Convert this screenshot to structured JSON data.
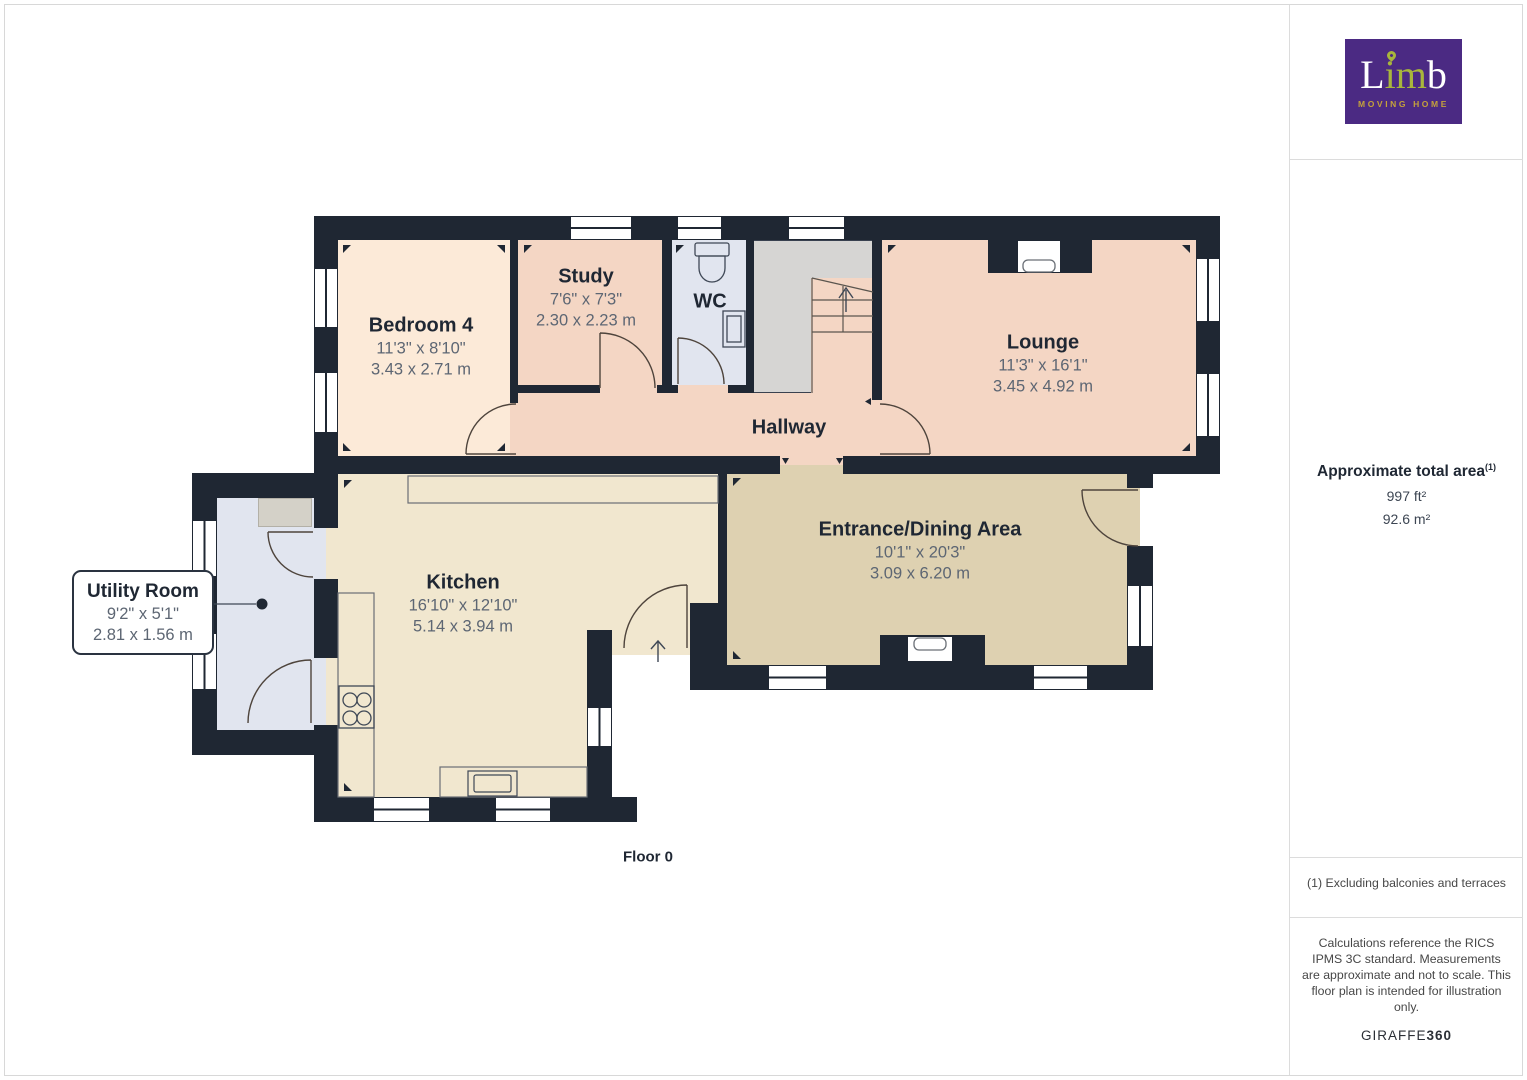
{
  "colors": {
    "wall": "#1f2733",
    "bedroom_floor": "#fcead8",
    "hall_lounge_study_floor": "#f4d6c4",
    "wc_utility_floor": "#e1e5ef",
    "stairs_gray": "#d6d5d3",
    "kitchen_floor": "#f1e7cf",
    "dining_floor": "#ded1b1",
    "logo_purple": "#4b2a83",
    "logo_green": "#a9b63c",
    "logo_gold": "#c5a23b"
  },
  "plan": {
    "floor_label": "Floor 0",
    "rooms": {
      "bedroom4": {
        "name": "Bedroom 4",
        "imperial": "11'3\" x 8'10\"",
        "metric": "3.43 x 2.71 m"
      },
      "study": {
        "name": "Study",
        "imperial": "7'6\" x 7'3\"",
        "metric": "2.30 x 2.23 m"
      },
      "wc": {
        "name": "WC"
      },
      "hallway": {
        "name": "Hallway"
      },
      "lounge": {
        "name": "Lounge",
        "imperial": "11'3\" x 16'1\"",
        "metric": "3.45 x 4.92 m"
      },
      "kitchen": {
        "name": "Kitchen",
        "imperial": "16'10\" x 12'10\"",
        "metric": "5.14 x 3.94 m"
      },
      "dining": {
        "name": "Entrance/Dining Area",
        "imperial": "10'1\" x 20'3\"",
        "metric": "3.09 x 6.20 m"
      },
      "utility": {
        "name": "Utility Room",
        "imperial": "9'2\" x 5'1\"",
        "metric": "2.81 x 1.56 m"
      }
    }
  },
  "sidebar": {
    "logo": {
      "brand_l": "L",
      "brand_im": "im",
      "brand_b": "b",
      "tagline": "MOVING HOME"
    },
    "area": {
      "title": "Approximate total area",
      "footnote_ref": "(1)",
      "imperial": "997 ft²",
      "metric": "92.6 m²"
    },
    "footnote": "(1) Excluding balconies and terraces",
    "disclaimer": "Calculations reference the RICS IPMS 3C standard. Measurements are approximate and not to scale. This floor plan is intended for illustration only.",
    "brand_name": "GIRAFFE",
    "brand_suffix": "360"
  }
}
